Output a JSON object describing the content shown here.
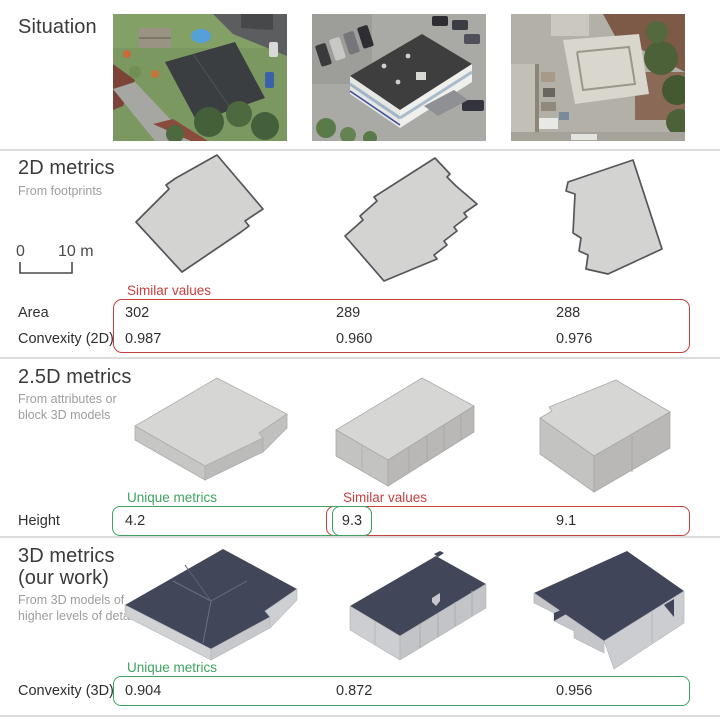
{
  "situation": {
    "title": "Situation"
  },
  "metrics2d": {
    "title": "2D metrics",
    "subtitle": "From footprints",
    "scalebar": {
      "zero": "0",
      "ten": "10 m"
    },
    "annotation_similar": "Similar values",
    "rows": [
      {
        "label": "Area",
        "values": [
          "302",
          "289",
          "288"
        ]
      },
      {
        "label": "Convexity (2D)",
        "values": [
          "0.987",
          "0.960",
          "0.976"
        ]
      }
    ]
  },
  "metrics25d": {
    "title": "2.5D metrics",
    "subtitle_line1": "From attributes or",
    "subtitle_line2": "block 3D models",
    "annotation_unique": "Unique metrics",
    "annotation_similar": "Similar values",
    "row": {
      "label": "Height",
      "values": [
        "4.2",
        "9.3",
        "9.1"
      ]
    }
  },
  "metrics3d": {
    "title_line1": "3D metrics",
    "title_line2": "(our work)",
    "subtitle_line1": "From 3D models of",
    "subtitle_line2": "higher levels of detail",
    "annotation_unique": "Unique metrics",
    "row": {
      "label": "Convexity (3D)",
      "values": [
        "0.904",
        "0.872",
        "0.956"
      ]
    }
  },
  "colors": {
    "annotation_red": "#c5403e",
    "annotation_green": "#3da35f",
    "footprint_fill": "#d3d3d1",
    "roof_dark": "#414658",
    "divider": "#dcdcdc"
  }
}
